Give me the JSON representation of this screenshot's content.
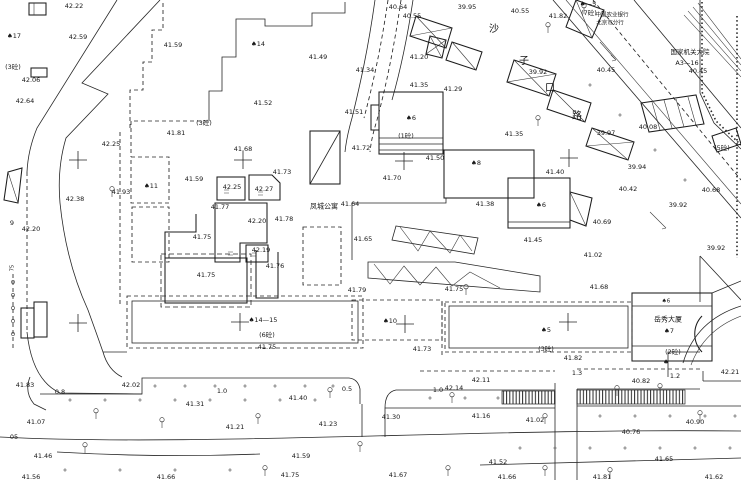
{
  "map": {
    "type": "cadastral-survey-plan",
    "background": "#ffffff",
    "ink": "#262626",
    "street_name": "沙子口路",
    "bank_name_line1": "中国农业银行",
    "bank_name_line2": "北京市分行",
    "compound_name": "国家机关大院",
    "compound_code": "A3—16",
    "apartment_name": "凤城公寓",
    "tower_name": "岳秀大厦"
  },
  "labels": [
    {
      "t": "42.22",
      "x": 74,
      "y": 6
    },
    {
      "t": "♠17",
      "x": 14,
      "y": 36,
      "n": "building-number"
    },
    {
      "t": "42.59",
      "x": 78,
      "y": 37
    },
    {
      "t": "41.59",
      "x": 173,
      "y": 45
    },
    {
      "t": "(3砼)",
      "x": 13,
      "y": 67,
      "n": "story-annotation"
    },
    {
      "t": "42.06",
      "x": 31,
      "y": 80
    },
    {
      "t": "42.64",
      "x": 25,
      "y": 101
    },
    {
      "t": "(3砼)",
      "x": 204,
      "y": 123,
      "n": "story-annotation"
    },
    {
      "t": "♠14",
      "x": 258,
      "y": 44,
      "n": "building-number"
    },
    {
      "t": "41.49",
      "x": 318,
      "y": 57
    },
    {
      "t": "40.64",
      "x": 398,
      "y": 7
    },
    {
      "t": "40.55",
      "x": 412,
      "y": 16
    },
    {
      "t": "39.95",
      "x": 467,
      "y": 7
    },
    {
      "t": "41.34",
      "x": 365,
      "y": 70
    },
    {
      "t": "41.20",
      "x": 419,
      "y": 57
    },
    {
      "t": "41.52",
      "x": 263,
      "y": 103
    },
    {
      "t": "41.51",
      "x": 354,
      "y": 112
    },
    {
      "t": "41.35",
      "x": 419,
      "y": 85
    },
    {
      "t": "41.29",
      "x": 453,
      "y": 89
    },
    {
      "t": "♠6",
      "x": 411,
      "y": 118,
      "n": "building-number"
    },
    {
      "t": "(1砼)",
      "x": 406,
      "y": 136,
      "n": "story-annotation"
    },
    {
      "t": "40.55",
      "x": 520,
      "y": 11
    },
    {
      "t": "41.82",
      "x": 558,
      "y": 16
    },
    {
      "t": "♠—5",
      "x": 588,
      "y": 4,
      "n": "building-number"
    },
    {
      "t": "(7砼)",
      "x": 589,
      "y": 13,
      "n": "story-annotation"
    },
    {
      "t": "中国农业银行",
      "x": 612,
      "y": 16,
      "fs": 5.5,
      "n": "bank-name"
    },
    {
      "t": "北京市分行",
      "x": 610,
      "y": 24,
      "fs": 5.5,
      "n": "bank-name"
    },
    {
      "t": "国家机关大院",
      "x": 690,
      "y": 52,
      "fs": 6.5,
      "n": "compound-name"
    },
    {
      "t": "A3—16",
      "x": 687,
      "y": 63,
      "n": "compound-code"
    },
    {
      "t": "沙",
      "x": 494,
      "y": 30,
      "n": "street-name-char",
      "cls": "st"
    },
    {
      "t": "子",
      "x": 524,
      "y": 62,
      "n": "street-name-char",
      "cls": "st"
    },
    {
      "t": "口",
      "x": 550,
      "y": 89,
      "n": "street-name-char",
      "cls": "st"
    },
    {
      "t": "路",
      "x": 577,
      "y": 117,
      "n": "street-name-char",
      "cls": "st"
    },
    {
      "t": "39.92",
      "x": 538,
      "y": 72
    },
    {
      "t": "40.45",
      "x": 606,
      "y": 70
    },
    {
      "t": "40.45",
      "x": 698,
      "y": 71
    },
    {
      "t": "40.08",
      "x": 648,
      "y": 127
    },
    {
      "t": "42.25",
      "x": 111,
      "y": 144
    },
    {
      "t": "41.81",
      "x": 176,
      "y": 133
    },
    {
      "t": "41.68",
      "x": 243,
      "y": 149
    },
    {
      "t": "41.73",
      "x": 282,
      "y": 172
    },
    {
      "t": "41.59",
      "x": 194,
      "y": 179
    },
    {
      "t": "♠11",
      "x": 151,
      "y": 186,
      "n": "building-number"
    },
    {
      "t": "41.93",
      "x": 121,
      "y": 192
    },
    {
      "t": "42.38",
      "x": 75,
      "y": 199
    },
    {
      "t": "42.25",
      "x": 232,
      "y": 187
    },
    {
      "t": "42.27",
      "x": 264,
      "y": 189
    },
    {
      "t": "41.77",
      "x": 220,
      "y": 207
    },
    {
      "t": "42.20",
      "x": 257,
      "y": 221
    },
    {
      "t": "41.78",
      "x": 284,
      "y": 219
    },
    {
      "t": "42.20",
      "x": 31,
      "y": 229
    },
    {
      "t": "9",
      "x": 12,
      "y": 223
    },
    {
      "t": "41.75",
      "x": 202,
      "y": 237
    },
    {
      "t": "42.19",
      "x": 261,
      "y": 250
    },
    {
      "t": "41.76",
      "x": 275,
      "y": 266
    },
    {
      "t": "41.75",
      "x": 206,
      "y": 275
    },
    {
      "t": "41.72",
      "x": 361,
      "y": 148
    },
    {
      "t": "41.70",
      "x": 392,
      "y": 178
    },
    {
      "t": "41.50",
      "x": 435,
      "y": 158
    },
    {
      "t": "♠8",
      "x": 476,
      "y": 163,
      "n": "building-number"
    },
    {
      "t": "41.64",
      "x": 350,
      "y": 204
    },
    {
      "t": "凤城公寓",
      "x": 324,
      "y": 207,
      "n": "building-name",
      "cls": "cn"
    },
    {
      "t": "41.65",
      "x": 363,
      "y": 239
    },
    {
      "t": "41.38",
      "x": 485,
      "y": 204
    },
    {
      "t": "41.35",
      "x": 514,
      "y": 134
    },
    {
      "t": "41.40",
      "x": 555,
      "y": 172
    },
    {
      "t": "♠6",
      "x": 541,
      "y": 205,
      "n": "building-number"
    },
    {
      "t": "41.45",
      "x": 533,
      "y": 240
    },
    {
      "t": "40.69",
      "x": 602,
      "y": 222
    },
    {
      "t": "39.97",
      "x": 606,
      "y": 133
    },
    {
      "t": "39.94",
      "x": 637,
      "y": 167
    },
    {
      "t": "40.42",
      "x": 628,
      "y": 189
    },
    {
      "t": "39.92",
      "x": 678,
      "y": 205
    },
    {
      "t": "40.68",
      "x": 711,
      "y": 190
    },
    {
      "t": "(5砼)",
      "x": 722,
      "y": 148,
      "n": "story-annotation"
    },
    {
      "t": "39.92",
      "x": 716,
      "y": 248
    },
    {
      "t": "41.02",
      "x": 593,
      "y": 255
    },
    {
      "t": "41.68",
      "x": 599,
      "y": 287
    },
    {
      "t": "41.75",
      "x": 454,
      "y": 289
    },
    {
      "t": "41.79",
      "x": 357,
      "y": 290
    },
    {
      "t": "♠14—15",
      "x": 263,
      "y": 320,
      "n": "building-number"
    },
    {
      "t": "(6砼)",
      "x": 267,
      "y": 335,
      "n": "story-annotation"
    },
    {
      "t": "41.75",
      "x": 267,
      "y": 347
    },
    {
      "t": "♠10",
      "x": 390,
      "y": 321,
      "n": "building-number"
    },
    {
      "t": "41.73",
      "x": 422,
      "y": 349
    },
    {
      "t": "♠5",
      "x": 546,
      "y": 330,
      "n": "building-number"
    },
    {
      "t": "(3砼)",
      "x": 546,
      "y": 349,
      "n": "story-annotation"
    },
    {
      "t": "41.82",
      "x": 573,
      "y": 358
    },
    {
      "t": "♠6",
      "x": 666,
      "y": 302,
      "fs": 5.5,
      "n": "building-number"
    },
    {
      "t": "岳秀大厦",
      "x": 668,
      "y": 320,
      "n": "building-name",
      "cls": "cn"
    },
    {
      "t": "♠7",
      "x": 669,
      "y": 331,
      "n": "building-number"
    },
    {
      "t": "(2砼)",
      "x": 673,
      "y": 352,
      "n": "story-annotation"
    },
    {
      "t": "♠",
      "x": 666,
      "y": 362,
      "n": "building-number"
    },
    {
      "t": "1.3",
      "x": 577,
      "y": 373,
      "n": "distance-annotation"
    },
    {
      "t": "1.2",
      "x": 675,
      "y": 376,
      "n": "distance-annotation"
    },
    {
      "t": "42.21",
      "x": 730,
      "y": 372
    },
    {
      "t": "40.82",
      "x": 641,
      "y": 381
    },
    {
      "t": "41.83",
      "x": 25,
      "y": 385
    },
    {
      "t": "0.8",
      "x": 60,
      "y": 392,
      "n": "distance-annotation"
    },
    {
      "t": "42.02",
      "x": 131,
      "y": 385
    },
    {
      "t": "1.0",
      "x": 222,
      "y": 391,
      "n": "distance-annotation"
    },
    {
      "t": "41.31",
      "x": 195,
      "y": 404
    },
    {
      "t": "41.07",
      "x": 36,
      "y": 422
    },
    {
      "t": "41.21",
      "x": 235,
      "y": 427
    },
    {
      "t": "05",
      "x": 14,
      "y": 437
    },
    {
      "t": "41.46",
      "x": 43,
      "y": 456
    },
    {
      "t": "41.56",
      "x": 31,
      "y": 477
    },
    {
      "t": "41.66",
      "x": 166,
      "y": 477
    },
    {
      "t": "0.5",
      "x": 347,
      "y": 389,
      "n": "distance-annotation"
    },
    {
      "t": "41.40",
      "x": 298,
      "y": 398
    },
    {
      "t": "1.0",
      "x": 438,
      "y": 390,
      "n": "distance-annotation"
    },
    {
      "t": "42.14",
      "x": 454,
      "y": 388
    },
    {
      "t": "42.11",
      "x": 481,
      "y": 380
    },
    {
      "t": "41.30",
      "x": 391,
      "y": 417
    },
    {
      "t": "41.16",
      "x": 481,
      "y": 416
    },
    {
      "t": "41.23",
      "x": 328,
      "y": 424
    },
    {
      "t": "41.59",
      "x": 301,
      "y": 456
    },
    {
      "t": "41.75",
      "x": 290,
      "y": 475
    },
    {
      "t": "41.67",
      "x": 398,
      "y": 475
    },
    {
      "t": "41.02",
      "x": 535,
      "y": 420
    },
    {
      "t": "40.90",
      "x": 695,
      "y": 422
    },
    {
      "t": "40.76",
      "x": 631,
      "y": 432
    },
    {
      "t": "41.52",
      "x": 498,
      "y": 462
    },
    {
      "t": "41.65",
      "x": 664,
      "y": 459
    },
    {
      "t": "41.66",
      "x": 507,
      "y": 477
    },
    {
      "t": "41.81",
      "x": 602,
      "y": 477
    },
    {
      "t": "41.62",
      "x": 714,
      "y": 477
    },
    {
      "t": "75",
      "x": 13,
      "y": 268,
      "fs": 5,
      "rot": -90
    }
  ]
}
